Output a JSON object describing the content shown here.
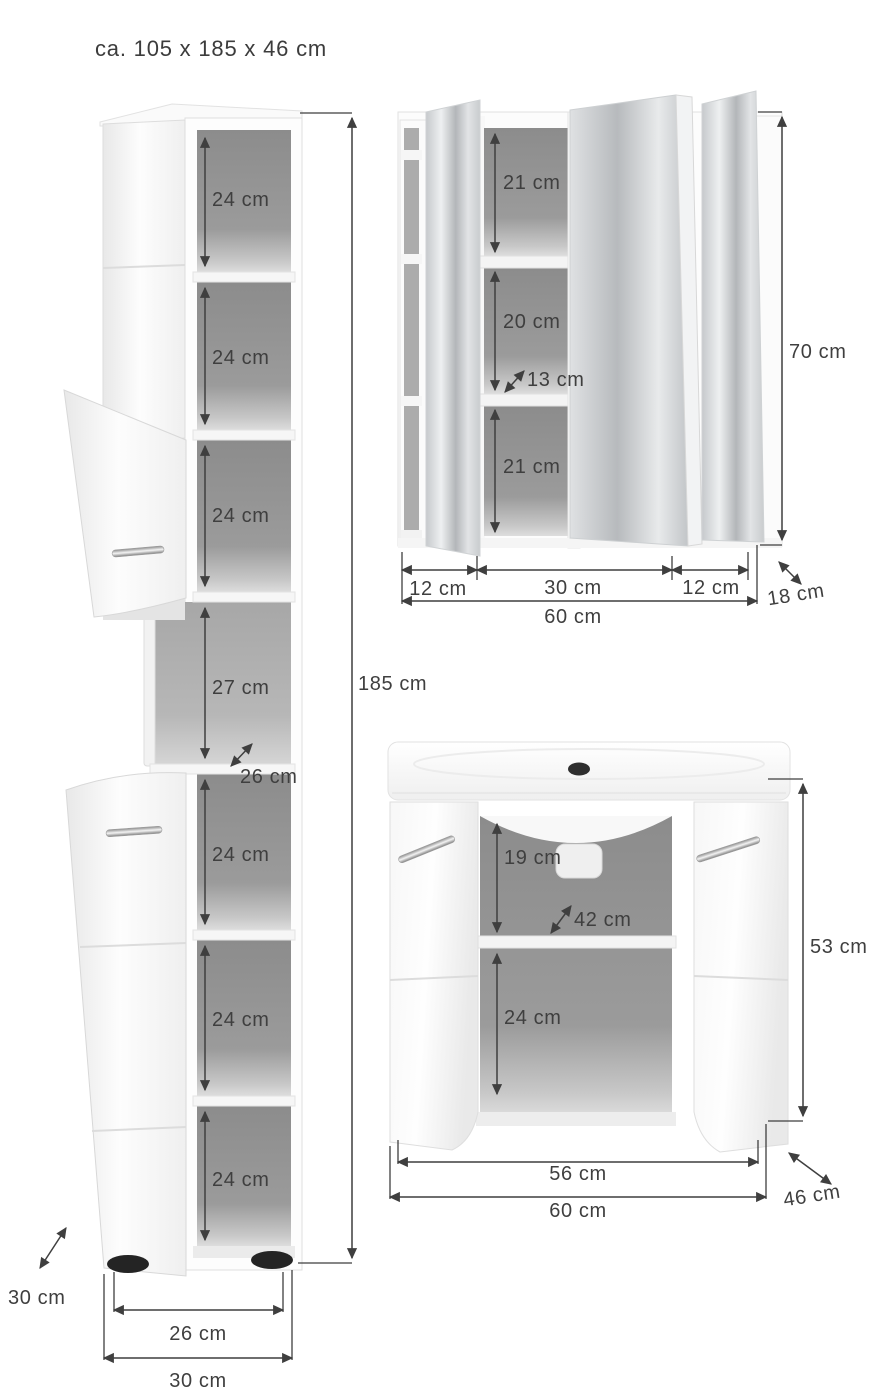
{
  "title": "ca. 105 x 185 x 46 cm",
  "tall_cabinet": {
    "compartments": [
      "24 cm",
      "24 cm",
      "24 cm",
      "27 cm",
      "24 cm",
      "24 cm",
      "24 cm"
    ],
    "niche_depth": "26 cm",
    "height": "185 cm",
    "inner_width": "26 cm",
    "outer_width": "30 cm",
    "depth": "30 cm"
  },
  "mirror_cabinet": {
    "compartments": [
      "21 cm",
      "20 cm",
      "21 cm"
    ],
    "shelf_depth": "13 cm",
    "height": "70 cm",
    "width_segments": [
      "12 cm",
      "30 cm",
      "12 cm"
    ],
    "total_width": "60 cm",
    "depth": "18 cm"
  },
  "vanity_cabinet": {
    "upper_height": "19 cm",
    "shelf_depth": "42 cm",
    "lower_height": "24 cm",
    "height": "53 cm",
    "inner_width": "56 cm",
    "outer_width": "60 cm",
    "depth": "46 cm"
  },
  "colors": {
    "text": "#3f3f3f",
    "dimension_line": "#3f3f3f",
    "interior_gray": "#919191",
    "cabinet_white": "#fbfbfb",
    "mirror_gray": "#c6c9cc"
  }
}
